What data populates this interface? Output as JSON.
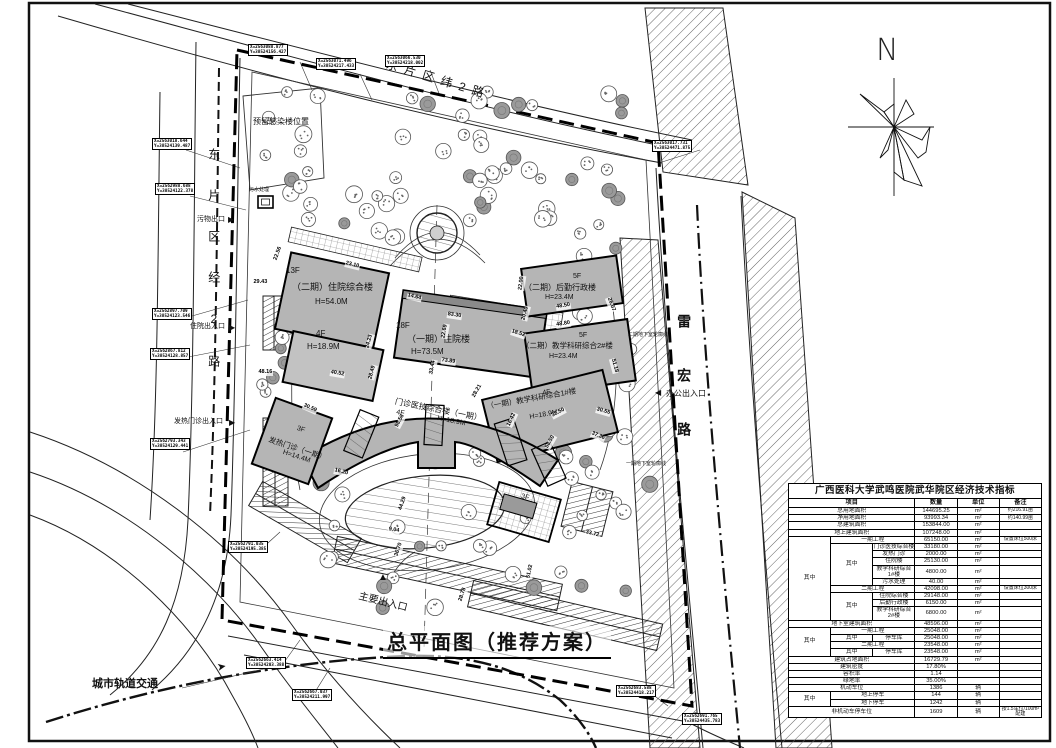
{
  "title_text": "总平面图（推荐方案）",
  "north_label": "N",
  "colors": {
    "building_fill": "#b5b5b5",
    "line": "#111111",
    "background": "#ffffff"
  },
  "table": {
    "title": "广西医科大学武鸣医院武华院区经济技术指标",
    "headers": [
      {
        "t": "项目",
        "cs": 3
      },
      {
        "t": "数量"
      },
      {
        "t": "单位"
      },
      {
        "t": "备注"
      }
    ],
    "rows": [
      [
        {
          "t": "总用地面积",
          "cs": 3
        },
        {
          "t": "144695.25"
        },
        {
          "t": "m²"
        },
        {
          "t": "约216.91亩",
          "n": 1
        }
      ],
      [
        {
          "t": "净用地面积",
          "cs": 3
        },
        {
          "t": "93993.34"
        },
        {
          "t": "m²"
        },
        {
          "t": "约140.99亩",
          "n": 1
        }
      ],
      [
        {
          "t": "总建筑面积",
          "cs": 3
        },
        {
          "t": "153844.00"
        },
        {
          "t": "m²"
        },
        {
          "t": ""
        }
      ],
      [
        {
          "t": "地上建筑面积",
          "cs": 3
        },
        {
          "t": "107248.00"
        },
        {
          "t": "m²"
        },
        {
          "t": ""
        }
      ],
      [
        {
          "t": "其中",
          "rs": 10,
          "v": 1
        },
        {
          "t": "一期工程",
          "cs": 2
        },
        {
          "t": "65150.00"
        },
        {
          "t": "m²"
        },
        {
          "t": "设置床位500床",
          "n": 1
        }
      ],
      [
        {
          "t": "其中",
          "rs": 5,
          "v": 1
        },
        {
          "t": "门诊医技综合楼"
        },
        {
          "t": "33180.00"
        },
        {
          "t": "m²"
        },
        {
          "t": ""
        }
      ],
      [
        {
          "t": "发热门诊"
        },
        {
          "t": "2000.00"
        },
        {
          "t": "m²"
        },
        {
          "t": ""
        }
      ],
      [
        {
          "t": "住院楼"
        },
        {
          "t": "25130.00"
        },
        {
          "t": "m²"
        },
        {
          "t": ""
        }
      ],
      [
        {
          "t": "教学科研综合1#楼"
        },
        {
          "t": "4800.00"
        },
        {
          "t": "m²"
        },
        {
          "t": ""
        }
      ],
      [
        {
          "t": "污水处理"
        },
        {
          "t": "40.00"
        },
        {
          "t": "m²"
        },
        {
          "t": ""
        }
      ],
      [
        {
          "t": "二期工程",
          "cs": 2
        },
        {
          "t": "42098.00"
        },
        {
          "t": "m²"
        },
        {
          "t": "设置床位300床",
          "n": 1
        }
      ],
      [
        {
          "t": "其中",
          "rs": 3,
          "v": 1
        },
        {
          "t": "住院综合楼"
        },
        {
          "t": "29148.00"
        },
        {
          "t": "m²"
        },
        {
          "t": ""
        }
      ],
      [
        {
          "t": "后勤行政楼"
        },
        {
          "t": "6150.00"
        },
        {
          "t": "m²"
        },
        {
          "t": ""
        }
      ],
      [
        {
          "t": "教学科研综合2#楼"
        },
        {
          "t": "6800.00"
        },
        {
          "t": "m²"
        },
        {
          "t": ""
        }
      ],
      [
        {
          "t": "地下室建筑面积",
          "cs": 3
        },
        {
          "t": "48596.00"
        },
        {
          "t": "m²"
        },
        {
          "t": ""
        }
      ],
      [
        {
          "t": "其中",
          "rs": 4,
          "v": 1
        },
        {
          "t": "一期工程",
          "cs": 2
        },
        {
          "t": "25048.00"
        },
        {
          "t": "m²"
        },
        {
          "t": ""
        }
      ],
      [
        {
          "t": "其中"
        },
        {
          "t": "停车库"
        },
        {
          "t": "25048.00"
        },
        {
          "t": "m²"
        },
        {
          "t": ""
        }
      ],
      [
        {
          "t": "二期工程",
          "cs": 2
        },
        {
          "t": "23548.00"
        },
        {
          "t": "m²"
        },
        {
          "t": ""
        }
      ],
      [
        {
          "t": "其中"
        },
        {
          "t": "停车库"
        },
        {
          "t": "23548.00"
        },
        {
          "t": "m²"
        },
        {
          "t": ""
        }
      ],
      [
        {
          "t": "建筑占地面积",
          "cs": 3
        },
        {
          "t": "16729.79"
        },
        {
          "t": "m²"
        },
        {
          "t": ""
        }
      ],
      [
        {
          "t": "建筑密度",
          "cs": 3
        },
        {
          "t": "17.80%"
        },
        {
          "t": ""
        },
        {
          "t": ""
        }
      ],
      [
        {
          "t": "容积率",
          "cs": 3
        },
        {
          "t": "1.14"
        },
        {
          "t": ""
        },
        {
          "t": ""
        }
      ],
      [
        {
          "t": "绿地率",
          "cs": 3
        },
        {
          "t": "35.00%"
        },
        {
          "t": ""
        },
        {
          "t": ""
        }
      ],
      [
        {
          "t": "机动车位",
          "cs": 3
        },
        {
          "t": "1386"
        },
        {
          "t": "辆"
        },
        {
          "t": ""
        }
      ],
      [
        {
          "t": "其中",
          "rs": 2,
          "v": 1
        },
        {
          "t": "地上停车",
          "cs": 2
        },
        {
          "t": "144"
        },
        {
          "t": "辆"
        },
        {
          "t": ""
        }
      ],
      [
        {
          "t": "地下停车",
          "cs": 2
        },
        {
          "t": "1242"
        },
        {
          "t": "辆"
        },
        {
          "t": ""
        }
      ],
      [
        {
          "t": "非机动车停车位",
          "cs": 3
        },
        {
          "t": "1609"
        },
        {
          "t": "辆"
        },
        {
          "t": "按1.5车位/100m²配建",
          "n": 1
        }
      ]
    ]
  },
  "map_labels": [
    {
      "n": "road-label-top",
      "t": "东片区纬2路",
      "x": 388,
      "y": 58,
      "fs": 12,
      "r": 17,
      "ls": 7
    },
    {
      "n": "road-label-left",
      "t": "东片区经2路",
      "x": 206,
      "y": 148,
      "fs": 12,
      "vert": 1,
      "ls": 29
    },
    {
      "n": "road-label-leihong",
      "t": "雷宏路",
      "x": 676,
      "y": 314,
      "fs": 14,
      "vert": 1,
      "ls": 40,
      "cls": "b"
    },
    {
      "n": "metro-label",
      "t": "城市轨道交通",
      "x": 92,
      "y": 678,
      "fs": 11,
      "cls": "b"
    },
    {
      "n": "building-label",
      "t": "13F",
      "x": 286,
      "y": 266,
      "fs": 8
    },
    {
      "n": "building-label",
      "t": "（二期）住院综合楼",
      "x": 292,
      "y": 282,
      "fs": 9
    },
    {
      "n": "building-label",
      "t": "H=54.0M",
      "x": 315,
      "y": 297,
      "fs": 8
    },
    {
      "n": "building-label",
      "t": "4F",
      "x": 316,
      "y": 329,
      "fs": 8
    },
    {
      "n": "building-label",
      "t": "H=18.9M",
      "x": 307,
      "y": 342,
      "fs": 8
    },
    {
      "n": "building-label",
      "t": "18F",
      "x": 396,
      "y": 321,
      "fs": 8
    },
    {
      "n": "building-label",
      "t": "（一期）住院楼",
      "x": 407,
      "y": 334,
      "fs": 9
    },
    {
      "n": "building-label",
      "t": "H=73.5M",
      "x": 411,
      "y": 347,
      "fs": 8
    },
    {
      "n": "building-label",
      "t": "5F",
      "x": 573,
      "y": 273,
      "fs": 7
    },
    {
      "n": "building-label",
      "t": "（二期）后勤行政楼",
      "x": 524,
      "y": 283,
      "fs": 8
    },
    {
      "n": "building-label",
      "t": "H=23.4M",
      "x": 545,
      "y": 294,
      "fs": 7
    },
    {
      "n": "building-label",
      "t": "5F",
      "x": 579,
      "y": 332,
      "fs": 7
    },
    {
      "n": "building-label",
      "t": "（二期）教学科研综合2#楼",
      "x": 522,
      "y": 342,
      "fs": 7.5
    },
    {
      "n": "building-label",
      "t": "H=23.4M",
      "x": 549,
      "y": 353,
      "fs": 7
    },
    {
      "n": "building-label",
      "t": "4F",
      "x": 542,
      "y": 390,
      "fs": 7,
      "r": -10
    },
    {
      "n": "building-label",
      "t": "（一期）教学科研综合1#楼",
      "x": 486,
      "y": 403,
      "fs": 7.5,
      "r": -10
    },
    {
      "n": "building-label",
      "t": "H=18.9M",
      "x": 529,
      "y": 414,
      "fs": 7,
      "r": -10
    },
    {
      "n": "building-label",
      "t": "门诊医技综合楼（一期）",
      "x": 396,
      "y": 397,
      "fs": 8,
      "r": 11
    },
    {
      "n": "building-label",
      "t": "4F",
      "x": 397,
      "y": 409,
      "fs": 7,
      "r": 11
    },
    {
      "n": "building-label",
      "t": "H=18.9M",
      "x": 438,
      "y": 415,
      "fs": 7,
      "r": 11
    },
    {
      "n": "building-label",
      "t": "3F",
      "x": 298,
      "y": 425,
      "fs": 7,
      "r": 18
    },
    {
      "n": "building-label",
      "t": "发热门诊（一期）",
      "x": 270,
      "y": 436,
      "fs": 7.5,
      "r": 18
    },
    {
      "n": "building-label",
      "t": "H=14.4M",
      "x": 284,
      "y": 449,
      "fs": 7,
      "r": 18
    },
    {
      "n": "building-label",
      "t": "3F",
      "x": 522,
      "y": 493,
      "fs": 7,
      "r": 14
    },
    {
      "n": "building-label",
      "t": "污水处理",
      "x": 249,
      "y": 188,
      "fs": 5
    },
    {
      "n": "reserved-area-label",
      "t": "预留感染楼位置",
      "x": 253,
      "y": 117,
      "fs": 8
    },
    {
      "n": "underground-outline-label",
      "t": "二期地下室轮廓线",
      "x": 628,
      "y": 333,
      "fs": 5
    },
    {
      "n": "underground-outline-label",
      "t": "一期地下室轮廓线",
      "x": 626,
      "y": 462,
      "fs": 5
    },
    {
      "n": "entrance-label",
      "t": "污物出口",
      "x": 197,
      "y": 216,
      "fs": 7
    },
    {
      "n": "entrance-arrow",
      "t": "▶",
      "x": 228,
      "y": 215,
      "fs": 8,
      "cls": "tri"
    },
    {
      "n": "entrance-label",
      "t": "住院出入口",
      "x": 190,
      "y": 323,
      "fs": 7
    },
    {
      "n": "entrance-arrow",
      "t": "▶",
      "x": 229,
      "y": 323,
      "fs": 8,
      "cls": "tri"
    },
    {
      "n": "entrance-label",
      "t": "发热门诊出入口",
      "x": 174,
      "y": 418,
      "fs": 7
    },
    {
      "n": "entrance-arrow",
      "t": "▶",
      "x": 229,
      "y": 418,
      "fs": 8,
      "cls": "tri"
    },
    {
      "n": "entrance-label",
      "t": "主要出入口",
      "x": 360,
      "y": 591,
      "fs": 10,
      "r": 14
    },
    {
      "n": "entrance-arrow",
      "t": "▲",
      "x": 378,
      "y": 572,
      "fs": 10,
      "cls": "tri"
    },
    {
      "n": "entrance-label",
      "t": "办公出入口",
      "x": 666,
      "y": 389,
      "fs": 8
    },
    {
      "n": "entrance-arrow",
      "t": "◀",
      "x": 655,
      "y": 388,
      "fs": 8,
      "cls": "tri"
    },
    {
      "n": "metro-arrow",
      "t": "➤",
      "x": 216,
      "y": 662,
      "fs": 11,
      "r": -10,
      "cls": "tri"
    }
  ],
  "dims": [
    [
      "23.10",
      345,
      261,
      14
    ],
    [
      "14.64",
      407,
      293,
      14
    ],
    [
      "83.30",
      447,
      312,
      9
    ],
    [
      "22.69",
      444,
      336,
      -80
    ],
    [
      "73.89",
      441,
      358,
      8
    ],
    [
      "33.44",
      432,
      372,
      -80
    ],
    [
      "24.23",
      368,
      346,
      -75
    ],
    [
      "28.49",
      371,
      377,
      -75
    ],
    [
      "40.52",
      330,
      370,
      10
    ],
    [
      "48.16",
      258,
      370,
      0
    ],
    [
      "29.43",
      253,
      280,
      0
    ],
    [
      "22.56",
      276,
      258,
      -70
    ],
    [
      "22.00",
      521,
      288,
      -82
    ],
    [
      "48.50",
      556,
      305,
      -9
    ],
    [
      "48.80",
      556,
      323,
      -9
    ],
    [
      "20.40",
      524,
      318,
      -75
    ],
    [
      "18.52",
      511,
      329,
      18
    ],
    [
      "26.07",
      608,
      295,
      70
    ],
    [
      "51.18",
      612,
      356,
      75
    ],
    [
      "30.55",
      596,
      407,
      16
    ],
    [
      "37.36",
      591,
      431,
      22
    ],
    [
      "38.50",
      552,
      414,
      -28
    ],
    [
      "58.50",
      547,
      446,
      -60
    ],
    [
      "16.42",
      509,
      424,
      -65
    ],
    [
      "28.21",
      474,
      395,
      -60
    ],
    [
      "98.58",
      397,
      425,
      -62
    ],
    [
      "30.59",
      303,
      403,
      24
    ],
    [
      "16.20",
      334,
      468,
      14
    ],
    [
      "9.04",
      388,
      527,
      10
    ],
    [
      "44.29",
      401,
      508,
      -72
    ],
    [
      "33.72",
      585,
      530,
      14
    ],
    [
      "51.02",
      529,
      576,
      -78
    ],
    [
      "28.78",
      461,
      599,
      -72
    ],
    [
      "36.70",
      397,
      554,
      -72
    ]
  ],
  "coords": [
    [
      248,
      44,
      "X=2563088.877",
      "Y=38524156.427"
    ],
    [
      316,
      58,
      "X=2563071.496",
      "Y=38524217.433"
    ],
    [
      385,
      55,
      "X=2563066.530",
      "Y=38524218.002"
    ],
    [
      152,
      138,
      "X=2563018.644",
      "Y=38524139.487"
    ],
    [
      155,
      183,
      "X=2562988.688",
      "Y=38524122.378"
    ],
    [
      152,
      308,
      "X=2562897.709",
      "Y=38524123.546"
    ],
    [
      150,
      348,
      "X=2562867.812",
      "Y=38524128.857"
    ],
    [
      150,
      438,
      "X=2562793.343",
      "Y=38524129.441"
    ],
    [
      228,
      541,
      "X=2562791.035",
      "Y=38524195.385"
    ],
    [
      652,
      140,
      "X=2563017.731",
      "Y=38524471.875"
    ],
    [
      246,
      657,
      "X=2562663.414",
      "Y=38524203.388"
    ],
    [
      292,
      689,
      "X=2562667.037",
      "Y=38524211.997"
    ],
    [
      616,
      685,
      "X=2562683.588",
      "Y=38524418.217"
    ],
    [
      682,
      713,
      "X=2562691.765",
      "Y=38524435.783"
    ]
  ]
}
